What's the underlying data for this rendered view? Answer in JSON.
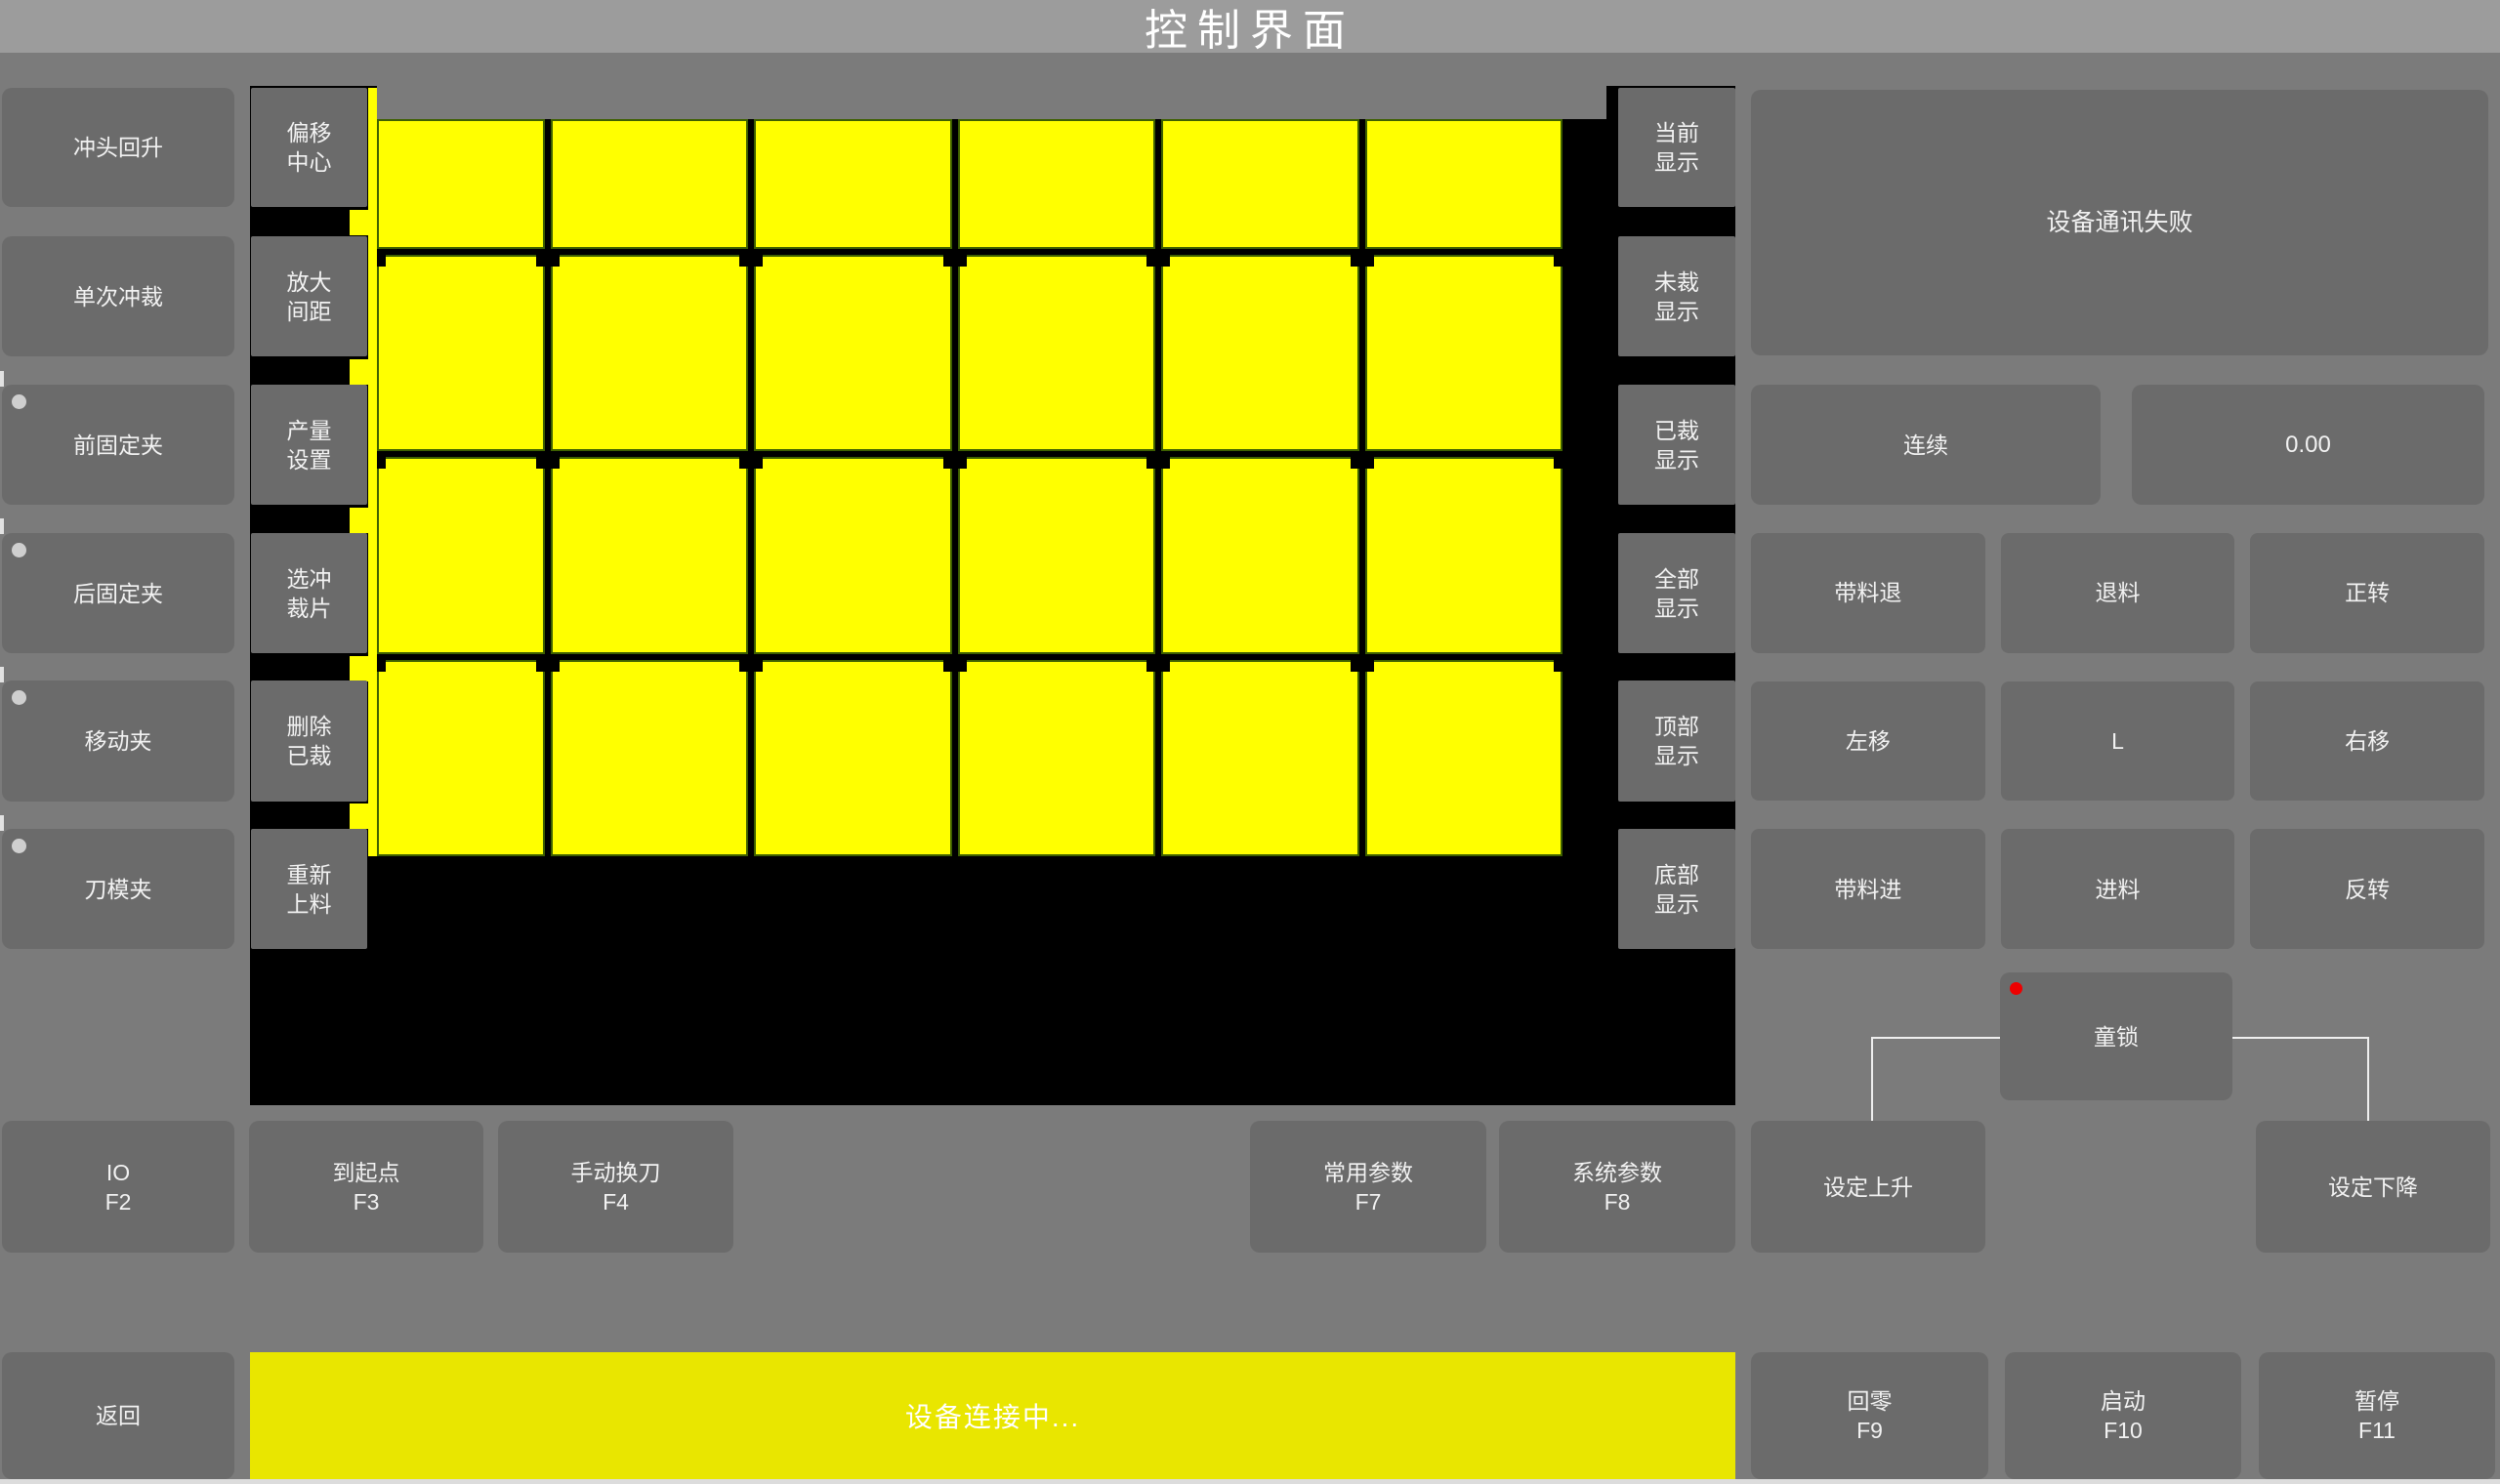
{
  "title": "控制界面",
  "left_buttons": [
    {
      "label": "冲头回升",
      "dot": false
    },
    {
      "label": "单次冲裁",
      "dot": false
    },
    {
      "label": "前固定夹",
      "dot": true
    },
    {
      "label": "后固定夹",
      "dot": true
    },
    {
      "label": "移动夹",
      "dot": true
    },
    {
      "label": "刀模夹",
      "dot": true
    }
  ],
  "tool_buttons": [
    {
      "line1": "偏移",
      "line2": "中心"
    },
    {
      "line1": "放大",
      "line2": "间距"
    },
    {
      "line1": "产量",
      "line2": "设置"
    },
    {
      "line1": "选冲",
      "line2": "裁片"
    },
    {
      "line1": "删除",
      "line2": "已裁"
    },
    {
      "line1": "重新",
      "line2": "上料"
    }
  ],
  "display_buttons": [
    {
      "line1": "当前",
      "line2": "显示"
    },
    {
      "line1": "未裁",
      "line2": "显示"
    },
    {
      "line1": "已裁",
      "line2": "显示"
    },
    {
      "line1": "全部",
      "line2": "显示"
    },
    {
      "line1": "顶部",
      "line2": "显示"
    },
    {
      "line1": "底部",
      "line2": "显示"
    }
  ],
  "canvas": {
    "grid": {
      "rows": 4,
      "cols": 6
    },
    "piece_color": "#ffff00"
  },
  "right_panel": {
    "message": "设备通讯失败",
    "mode_button": "连续",
    "value_display": "0.00",
    "jog_buttons": [
      "带料退",
      "退料",
      "正转",
      "左移",
      "L",
      "右移",
      "带料进",
      "进料",
      "反转"
    ],
    "child_lock": "童锁"
  },
  "function_row": {
    "io": {
      "label": "IO",
      "fkey": "F2"
    },
    "origin": {
      "label": "到起点",
      "fkey": "F3"
    },
    "tool": {
      "label": "手动换刀",
      "fkey": "F4"
    },
    "common": {
      "label": "常用参数",
      "fkey": "F7"
    },
    "system": {
      "label": "系统参数",
      "fkey": "F8"
    },
    "set_rise": {
      "label": "设定上升"
    },
    "set_fall": {
      "label": "设定下降"
    }
  },
  "bottom_bar": {
    "back": {
      "label": "返回"
    },
    "status": "设备连接中...",
    "home": {
      "label": "回零",
      "fkey": "F9"
    },
    "start": {
      "label": "启动",
      "fkey": "F10"
    },
    "pause": {
      "label": "暂停",
      "fkey": "F11"
    }
  },
  "colors": {
    "piece_yellow": "#ffff00",
    "status_bar_yellow": "#e9e600",
    "alert_red": "#ee0000",
    "canvas_black": "#000000",
    "button_gray": "#6b6b6b"
  }
}
